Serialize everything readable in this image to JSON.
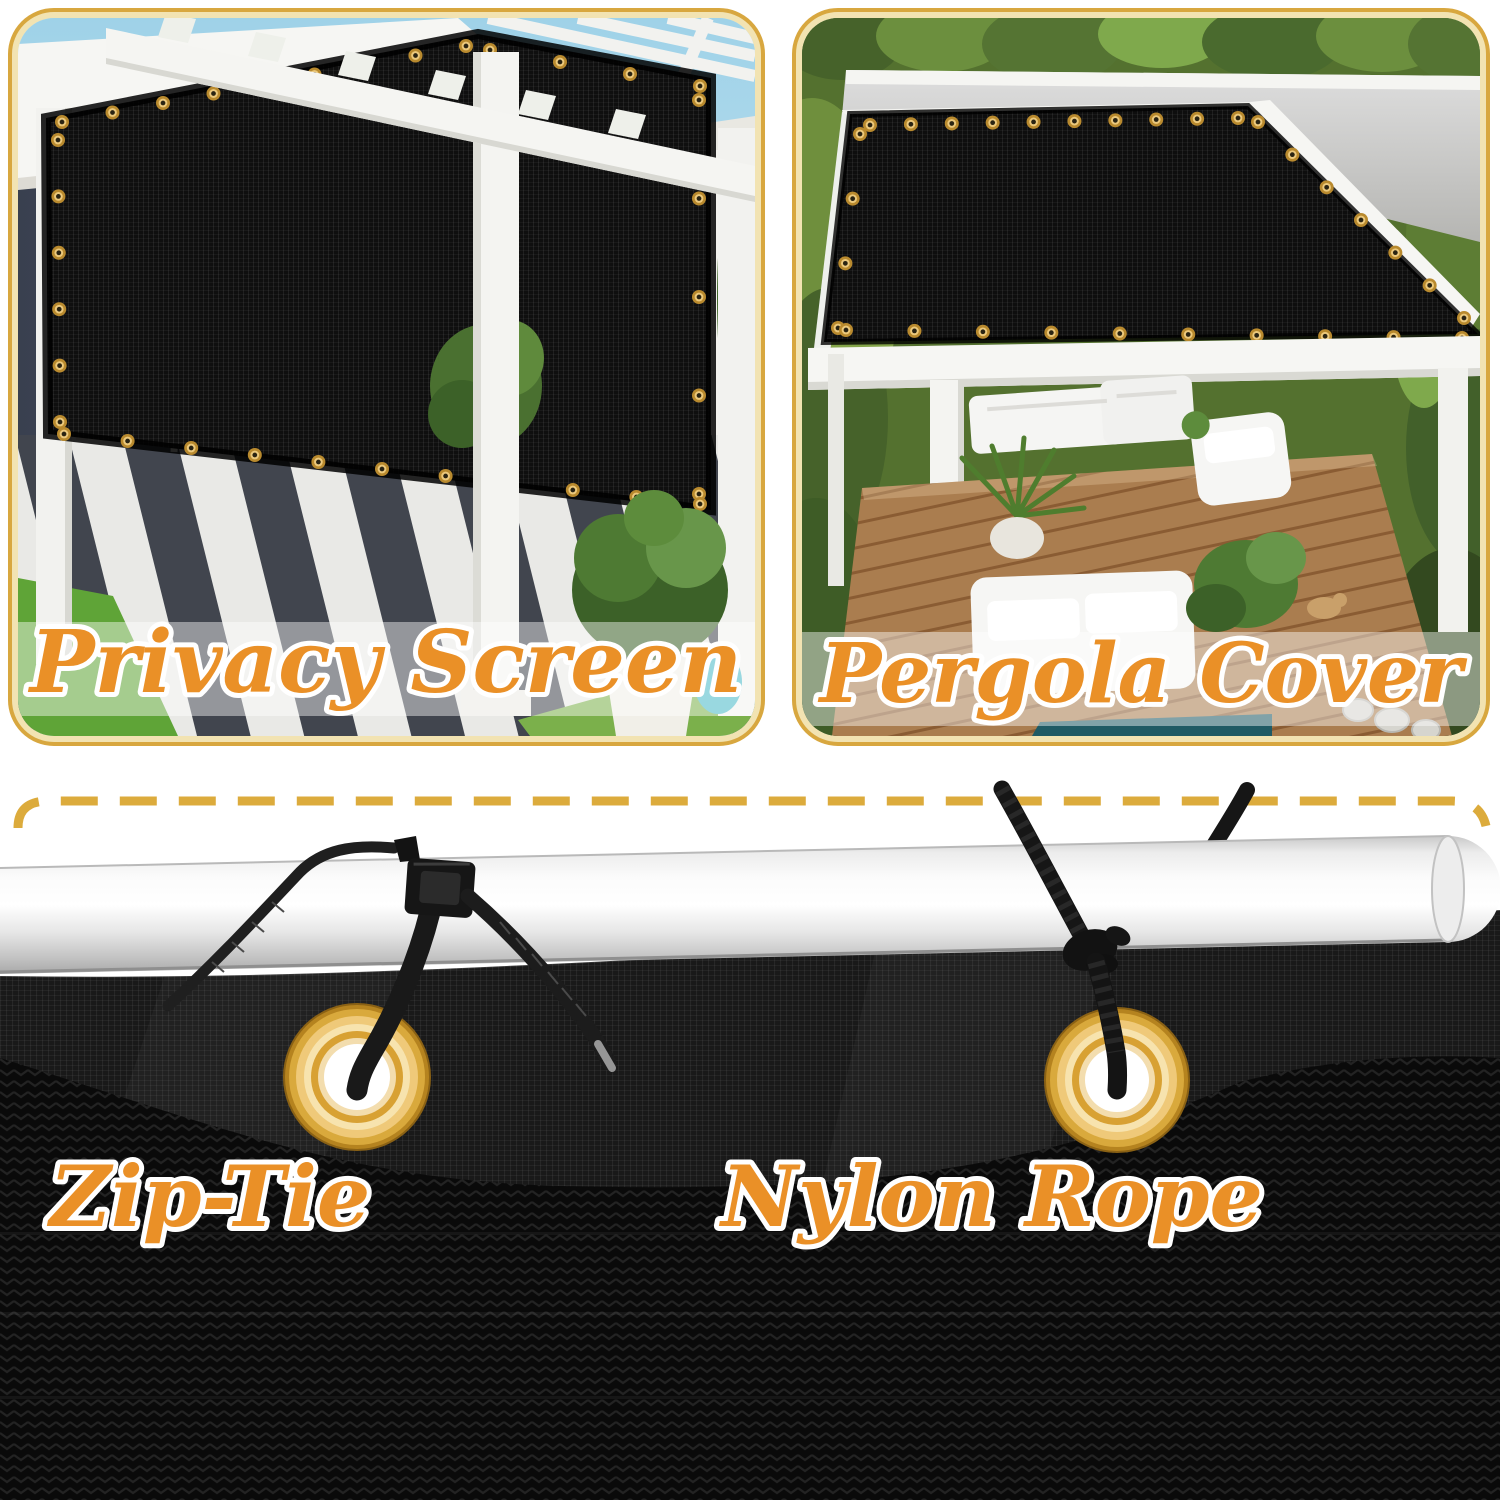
{
  "page": {
    "type": "product-image-collage",
    "background": "#ffffff"
  },
  "panels": [
    {
      "id": "privacy-screen",
      "caption": "Privacy Screen"
    },
    {
      "id": "pergola-cover",
      "caption": "Pergola Cover"
    }
  ],
  "attachments": [
    {
      "id": "zip-tie",
      "label": "Zip-Tie"
    },
    {
      "id": "nylon-rope",
      "label": "Nylon Rope"
    }
  ],
  "colors": {
    "caption_text": "#EA9027",
    "caption_outline": "#FFFFFF",
    "panel_border_gold": "#D8A73F",
    "panel_border_cream": "#F2E3B2",
    "dashed_line_gold": "#DCAB3C",
    "grommet_gold": "#D9A93C",
    "grommet_cream": "#F7E3AE",
    "fabric_black": "#121212",
    "screen_black": "#0F0F0F",
    "pole_silver": "#E9E9E9",
    "cushion_teal": "#40C2D3"
  }
}
